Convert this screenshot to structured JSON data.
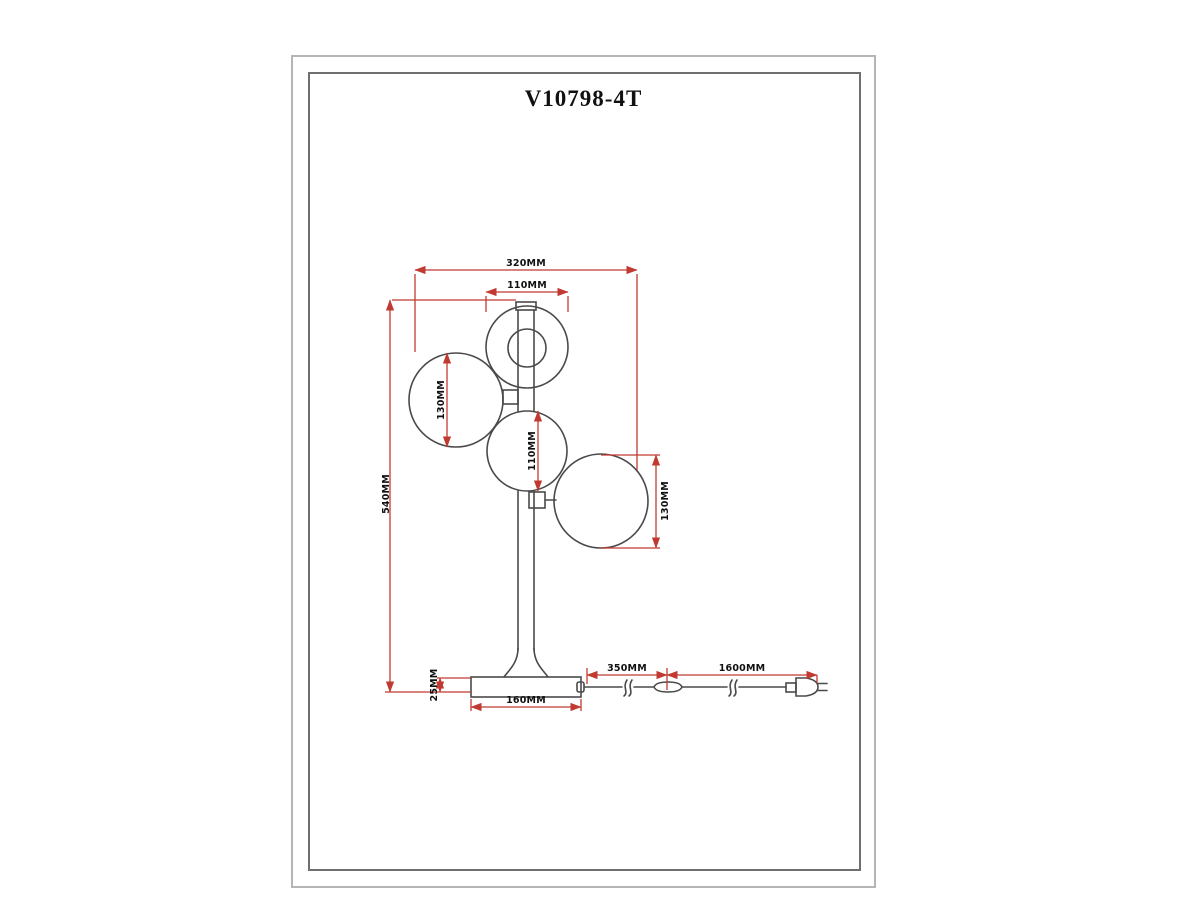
{
  "title": "V10798-4T",
  "dims": {
    "overall_width": "320MM",
    "top_globe_diameter": "110MM",
    "overall_height": "540MM",
    "left_globe_diameter": "130MM",
    "middle_globe_diameter": "110MM",
    "right_globe_diameter": "130MM",
    "base_height": "25MM",
    "base_diameter": "160MM",
    "cord_base_to_switch": "350MM",
    "cord_switch_to_plug": "1600MM"
  },
  "colors": {
    "outline": "#4a4a4a",
    "dimension": "#c13a31",
    "label": "#111111",
    "frame_outer": "#b5b5b5",
    "frame_inner": "#6f6f6f",
    "background": "#ffffff"
  }
}
